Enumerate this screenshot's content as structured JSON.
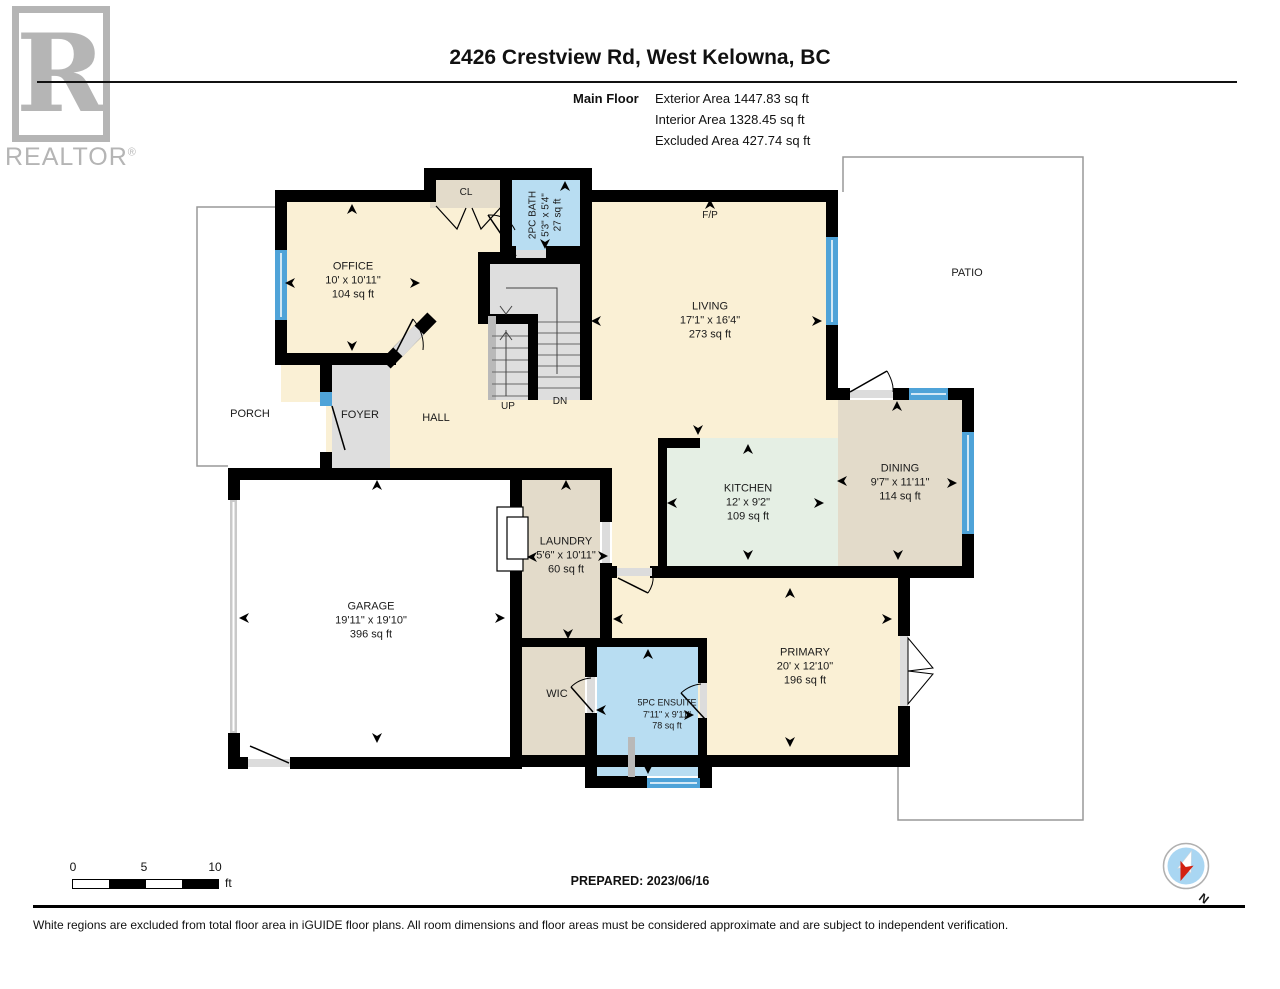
{
  "logo": {
    "letter": "R",
    "brand": "REALTOR",
    "registered": "®"
  },
  "header": {
    "title": "2426 Crestview Rd, West Kelowna, BC",
    "floor_label": "Main Floor",
    "area_lines": [
      "Exterior Area 1447.83 sq ft",
      "Interior Area 1328.45 sq ft",
      "Excluded Area 427.74 sq ft"
    ]
  },
  "rooms": {
    "office": {
      "name": "OFFICE",
      "dims": "10' x 10'11\"",
      "area": "104 sq ft"
    },
    "living": {
      "name": "LIVING",
      "dims": "17'1\" x 16'4\"",
      "area": "273 sq ft"
    },
    "kitchen": {
      "name": "KITCHEN",
      "dims": "12' x 9'2\"",
      "area": "109 sq ft"
    },
    "dining": {
      "name": "DINING",
      "dims": "9'7\" x 11'11\"",
      "area": "114 sq ft"
    },
    "garage": {
      "name": "GARAGE",
      "dims": "19'11\" x 19'10\"",
      "area": "396 sq ft"
    },
    "laundry": {
      "name": "LAUNDRY",
      "dims": "5'6\" x 10'11\"",
      "area": "60 sq ft"
    },
    "primary": {
      "name": "PRIMARY",
      "dims": "20' x 12'10\"",
      "area": "196 sq ft"
    },
    "ensuite": {
      "name": "5PC ENSUITE",
      "dims": "7'11\" x 9'11\"",
      "area": "78 sq ft"
    },
    "bath2pc": {
      "name": "2PC BATH",
      "dims": "5'3\" x 5'4\"",
      "area": "27 sq ft"
    },
    "wic": "WIC",
    "cl": "CL",
    "hall": "HALL",
    "foyer": "FOYER",
    "porch": "PORCH",
    "patio": "PATIO",
    "fireplace": "F/P",
    "up": "UP",
    "dn": "DN"
  },
  "scale_bar": {
    "tick0": "0",
    "tick5": "5",
    "tick10": "10",
    "unit": "ft"
  },
  "prepared": "PREPARED: 2023/06/16",
  "compass": {
    "north": "N"
  },
  "disclaimer": "White regions are excluded from total floor area in iGUIDE floor plans. All room dimensions and floor areas must be considered approximate and are subject to independent verification.",
  "colors": {
    "wall": "#000000",
    "floor_cream": "#FAF0D5",
    "floor_tan": "#E3DBCA",
    "floor_mint": "#E5EFE4",
    "floor_blue": "#B8DDF2",
    "floor_gray": "#DEDEDE",
    "window_blue": "#4FA3D8",
    "logo_gray": "#B5B5B5",
    "compass_red": "#D32011",
    "compass_blue": "#A9D6F2",
    "outline_gray": "#999999"
  }
}
